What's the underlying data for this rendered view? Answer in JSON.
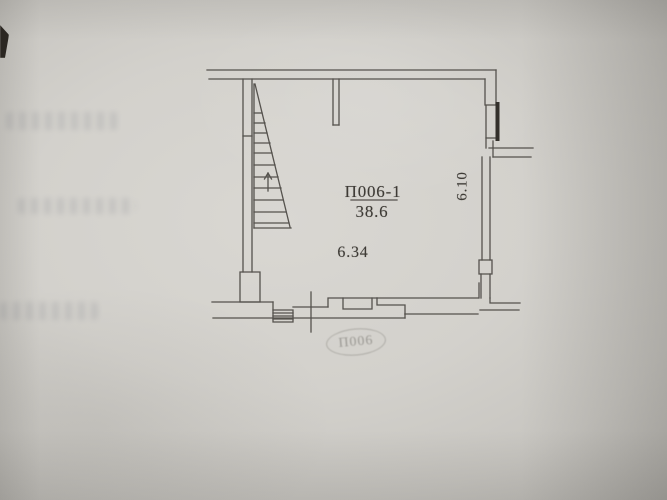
{
  "plan": {
    "room_label": "П006-1",
    "area_value": "38.6",
    "dimension_width": "6.34",
    "dimension_height": "6.10",
    "stamp_label": "П006"
  },
  "icons": {
    "stair_direction_arrow": "up-arrow"
  },
  "colors": {
    "paper_center": "#d9d7d2",
    "paper_edge": "#b2b0ab",
    "drawing_line": "#55524d",
    "window_bar_dark": "#33302b",
    "label_ink": "#3e3b36"
  }
}
